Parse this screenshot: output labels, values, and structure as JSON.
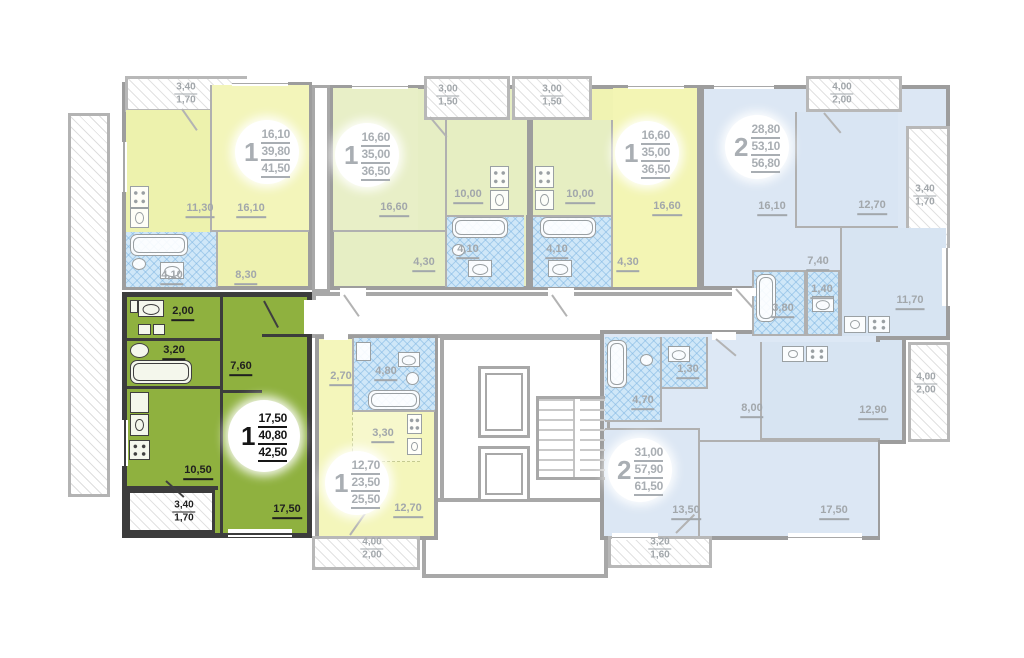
{
  "plan_name": "residential floor plan with selected apartment",
  "colors": {
    "selected_room": "#8fb13f",
    "selected_hall": "#cddd8d",
    "selected_wall": "#3c3c3c",
    "yellow_room": "#f3f5ba",
    "yellow_kitchen": "#edf2ad",
    "sage": "#e8efc7",
    "blue_room": "#dce7f4",
    "blue_kitchen": "#d7e4f2",
    "bath_blue": "#cfe7f8",
    "wall_gray": "#9d9d9d"
  },
  "apartments": {
    "a1": {
      "badge": {
        "n": "1",
        "v1": "16,10",
        "v2": "39,80",
        "v3": "41,50"
      },
      "labels": {
        "kitchen": "11,30",
        "room": "16,10",
        "bath": "4,10",
        "hall": "8,30",
        "balc_a": "3,40",
        "balc_b": "1,70"
      }
    },
    "a2": {
      "badge": {
        "n": "1",
        "v1": "16,60",
        "v2": "35,00",
        "v3": "36,50"
      },
      "labels": {
        "room": "16,60",
        "kitchen": "10,00",
        "bath": "4,10",
        "hall": "4,30",
        "balc_a": "3,00",
        "balc_b": "1,50"
      }
    },
    "a3": {
      "badge": {
        "n": "1",
        "v1": "16,60",
        "v2": "35,00",
        "v3": "36,50"
      },
      "labels": {
        "room": "16,60",
        "kitchen": "10,00",
        "bath": "4,10",
        "hall": "4,30",
        "balc_a": "3,00",
        "balc_b": "1,50"
      }
    },
    "a4": {
      "badge": {
        "n": "2",
        "v1": "28,80",
        "v2": "53,10",
        "v3": "56,80"
      },
      "labels": {
        "room1": "16,10",
        "room2": "12,70",
        "hall": "7,40",
        "wc": "1,40",
        "bath": "3,80",
        "kitchen": "11,70",
        "balc_top_a": "4,00",
        "balc_top_b": "2,00",
        "balc_right_a": "3,40",
        "balc_right_b": "1,70"
      }
    },
    "sel": {
      "badge": {
        "n": "1",
        "v1": "17,50",
        "v2": "40,80",
        "v3": "42,50"
      },
      "labels": {
        "wc": "2,00",
        "bath": "3,20",
        "hall": "7,60",
        "kitchen": "10,50",
        "room": "17,50",
        "balc_a": "3,40",
        "balc_b": "1,70"
      }
    },
    "st": {
      "badge": {
        "n": "1",
        "v1": "12,70",
        "v2": "23,50",
        "v3": "25,50"
      },
      "labels": {
        "hall": "2,70",
        "bath": "4,80",
        "niche": "3,30",
        "room": "12,70",
        "balc_a": "4,00",
        "balc_b": "2,00"
      }
    },
    "a7": {
      "badge": {
        "n": "2",
        "v1": "31,00",
        "v2": "57,90",
        "v3": "61,50"
      },
      "labels": {
        "bath": "4,70",
        "wc": "1,30",
        "hall": "8,00",
        "kitchen": "12,90",
        "room1": "13,50",
        "room2": "17,50",
        "balc_right_a": "4,00",
        "balc_right_b": "2,00",
        "balc_bot_a": "3,20",
        "balc_bot_b": "1,60"
      }
    }
  }
}
